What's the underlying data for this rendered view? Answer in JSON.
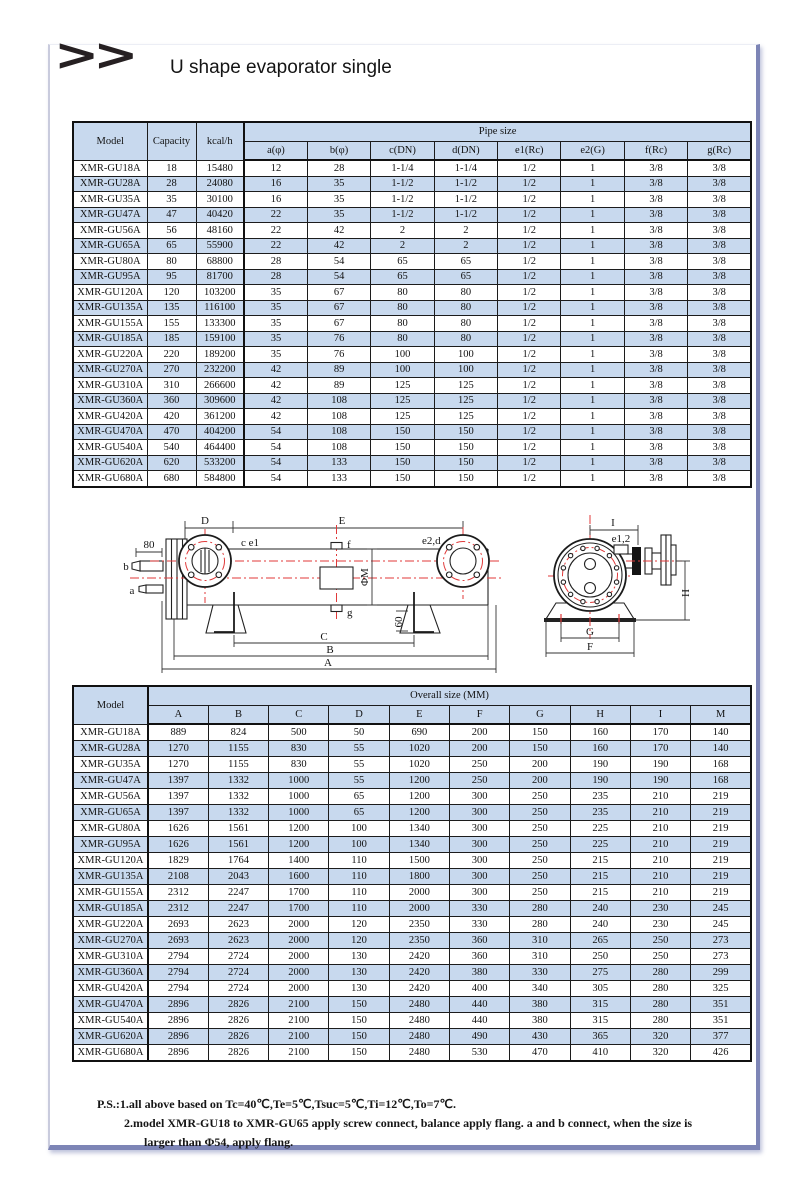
{
  "page": {
    "chevrons": ">>",
    "title": "U shape evaporator single"
  },
  "colors": {
    "stripe": "#c8d9ee",
    "frame": "#7d85b6",
    "red": "#e03a3a"
  },
  "pipe_table": {
    "col_model": "Model",
    "col_capacity": "Capacity",
    "col_kcal": "kcal/h",
    "group": "Pipe size",
    "subcols": [
      "a(φ)",
      "b(φ)",
      "c(DN)",
      "d(DN)",
      "e1(Rc)",
      "e2(G)",
      "f(Rc)",
      "g(Rc)"
    ],
    "rows": [
      [
        "XMR-GU18A",
        "18",
        "15480",
        "12",
        "28",
        "1-1/4",
        "1-1/4",
        "1/2",
        "1",
        "3/8",
        "3/8"
      ],
      [
        "XMR-GU28A",
        "28",
        "24080",
        "16",
        "35",
        "1-1/2",
        "1-1/2",
        "1/2",
        "1",
        "3/8",
        "3/8"
      ],
      [
        "XMR-GU35A",
        "35",
        "30100",
        "16",
        "35",
        "1-1/2",
        "1-1/2",
        "1/2",
        "1",
        "3/8",
        "3/8"
      ],
      [
        "XMR-GU47A",
        "47",
        "40420",
        "22",
        "35",
        "1-1/2",
        "1-1/2",
        "1/2",
        "1",
        "3/8",
        "3/8"
      ],
      [
        "XMR-GU56A",
        "56",
        "48160",
        "22",
        "42",
        "2",
        "2",
        "1/2",
        "1",
        "3/8",
        "3/8"
      ],
      [
        "XMR-GU65A",
        "65",
        "55900",
        "22",
        "42",
        "2",
        "2",
        "1/2",
        "1",
        "3/8",
        "3/8"
      ],
      [
        "XMR-GU80A",
        "80",
        "68800",
        "28",
        "54",
        "65",
        "65",
        "1/2",
        "1",
        "3/8",
        "3/8"
      ],
      [
        "XMR-GU95A",
        "95",
        "81700",
        "28",
        "54",
        "65",
        "65",
        "1/2",
        "1",
        "3/8",
        "3/8"
      ],
      [
        "XMR-GU120A",
        "120",
        "103200",
        "35",
        "67",
        "80",
        "80",
        "1/2",
        "1",
        "3/8",
        "3/8"
      ],
      [
        "XMR-GU135A",
        "135",
        "116100",
        "35",
        "67",
        "80",
        "80",
        "1/2",
        "1",
        "3/8",
        "3/8"
      ],
      [
        "XMR-GU155A",
        "155",
        "133300",
        "35",
        "67",
        "80",
        "80",
        "1/2",
        "1",
        "3/8",
        "3/8"
      ],
      [
        "XMR-GU185A",
        "185",
        "159100",
        "35",
        "76",
        "80",
        "80",
        "1/2",
        "1",
        "3/8",
        "3/8"
      ],
      [
        "XMR-GU220A",
        "220",
        "189200",
        "35",
        "76",
        "100",
        "100",
        "1/2",
        "1",
        "3/8",
        "3/8"
      ],
      [
        "XMR-GU270A",
        "270",
        "232200",
        "42",
        "89",
        "100",
        "100",
        "1/2",
        "1",
        "3/8",
        "3/8"
      ],
      [
        "XMR-GU310A",
        "310",
        "266600",
        "42",
        "89",
        "125",
        "125",
        "1/2",
        "1",
        "3/8",
        "3/8"
      ],
      [
        "XMR-GU360A",
        "360",
        "309600",
        "42",
        "108",
        "125",
        "125",
        "1/2",
        "1",
        "3/8",
        "3/8"
      ],
      [
        "XMR-GU420A",
        "420",
        "361200",
        "42",
        "108",
        "125",
        "125",
        "1/2",
        "1",
        "3/8",
        "3/8"
      ],
      [
        "XMR-GU470A",
        "470",
        "404200",
        "54",
        "108",
        "150",
        "150",
        "1/2",
        "1",
        "3/8",
        "3/8"
      ],
      [
        "XMR-GU540A",
        "540",
        "464400",
        "54",
        "108",
        "150",
        "150",
        "1/2",
        "1",
        "3/8",
        "3/8"
      ],
      [
        "XMR-GU620A",
        "620",
        "533200",
        "54",
        "133",
        "150",
        "150",
        "1/2",
        "1",
        "3/8",
        "3/8"
      ],
      [
        "XMR-GU680A",
        "680",
        "584800",
        "54",
        "133",
        "150",
        "150",
        "1/2",
        "1",
        "3/8",
        "3/8"
      ]
    ]
  },
  "diagram": {
    "side": {
      "dim_d": "D",
      "dim_e": "E",
      "dim_80": "80",
      "label_b": "b",
      "label_a": "a",
      "label_ce1": "c e1",
      "label_f": "f",
      "label_e2d": "e2,d",
      "label_phim": "ΦM",
      "label_g": "g",
      "dim_60": "60",
      "dim_c": "C",
      "dim_b": "B",
      "dim_a": "A"
    },
    "end": {
      "dim_i": "I",
      "label_e12": "e1,2",
      "dim_h": "H",
      "dim_g": "G",
      "dim_f": "F"
    }
  },
  "overall_table": {
    "col_model": "Model",
    "group": "Overall size (MM)",
    "subcols": [
      "A",
      "B",
      "C",
      "D",
      "E",
      "F",
      "G",
      "H",
      "I",
      "M"
    ],
    "rows": [
      [
        "XMR-GU18A",
        "889",
        "824",
        "500",
        "50",
        "690",
        "200",
        "150",
        "160",
        "170",
        "140"
      ],
      [
        "XMR-GU28A",
        "1270",
        "1155",
        "830",
        "55",
        "1020",
        "200",
        "150",
        "160",
        "170",
        "140"
      ],
      [
        "XMR-GU35A",
        "1270",
        "1155",
        "830",
        "55",
        "1020",
        "250",
        "200",
        "190",
        "190",
        "168"
      ],
      [
        "XMR-GU47A",
        "1397",
        "1332",
        "1000",
        "55",
        "1200",
        "250",
        "200",
        "190",
        "190",
        "168"
      ],
      [
        "XMR-GU56A",
        "1397",
        "1332",
        "1000",
        "65",
        "1200",
        "300",
        "250",
        "235",
        "210",
        "219"
      ],
      [
        "XMR-GU65A",
        "1397",
        "1332",
        "1000",
        "65",
        "1200",
        "300",
        "250",
        "235",
        "210",
        "219"
      ],
      [
        "XMR-GU80A",
        "1626",
        "1561",
        "1200",
        "100",
        "1340",
        "300",
        "250",
        "225",
        "210",
        "219"
      ],
      [
        "XMR-GU95A",
        "1626",
        "1561",
        "1200",
        "100",
        "1340",
        "300",
        "250",
        "225",
        "210",
        "219"
      ],
      [
        "XMR-GU120A",
        "1829",
        "1764",
        "1400",
        "110",
        "1500",
        "300",
        "250",
        "215",
        "210",
        "219"
      ],
      [
        "XMR-GU135A",
        "2108",
        "2043",
        "1600",
        "110",
        "1800",
        "300",
        "250",
        "215",
        "210",
        "219"
      ],
      [
        "XMR-GU155A",
        "2312",
        "2247",
        "1700",
        "110",
        "2000",
        "300",
        "250",
        "215",
        "210",
        "219"
      ],
      [
        "XMR-GU185A",
        "2312",
        "2247",
        "1700",
        "110",
        "2000",
        "330",
        "280",
        "240",
        "230",
        "245"
      ],
      [
        "XMR-GU220A",
        "2693",
        "2623",
        "2000",
        "120",
        "2350",
        "330",
        "280",
        "240",
        "230",
        "245"
      ],
      [
        "XMR-GU270A",
        "2693",
        "2623",
        "2000",
        "120",
        "2350",
        "360",
        "310",
        "265",
        "250",
        "273"
      ],
      [
        "XMR-GU310A",
        "2794",
        "2724",
        "2000",
        "130",
        "2420",
        "360",
        "310",
        "250",
        "250",
        "273"
      ],
      [
        "XMR-GU360A",
        "2794",
        "2724",
        "2000",
        "130",
        "2420",
        "380",
        "330",
        "275",
        "280",
        "299"
      ],
      [
        "XMR-GU420A",
        "2794",
        "2724",
        "2000",
        "130",
        "2420",
        "400",
        "340",
        "305",
        "280",
        "325"
      ],
      [
        "XMR-GU470A",
        "2896",
        "2826",
        "2100",
        "150",
        "2480",
        "440",
        "380",
        "315",
        "280",
        "351"
      ],
      [
        "XMR-GU540A",
        "2896",
        "2826",
        "2100",
        "150",
        "2480",
        "440",
        "380",
        "315",
        "280",
        "351"
      ],
      [
        "XMR-GU620A",
        "2896",
        "2826",
        "2100",
        "150",
        "2480",
        "490",
        "430",
        "365",
        "320",
        "377"
      ],
      [
        "XMR-GU680A",
        "2896",
        "2826",
        "2100",
        "150",
        "2480",
        "530",
        "470",
        "410",
        "320",
        "426"
      ]
    ]
  },
  "notes": {
    "line1": "P.S.:1.all above based on Tc=40℃,Te=5℃,Tsuc=5℃,Ti=12℃,To=7℃.",
    "line2": "2.model XMR-GU18 to XMR-GU65 apply screw connect, balance apply flang. a and b connect, when the size is",
    "line3": "larger than Φ54, apply flang."
  }
}
